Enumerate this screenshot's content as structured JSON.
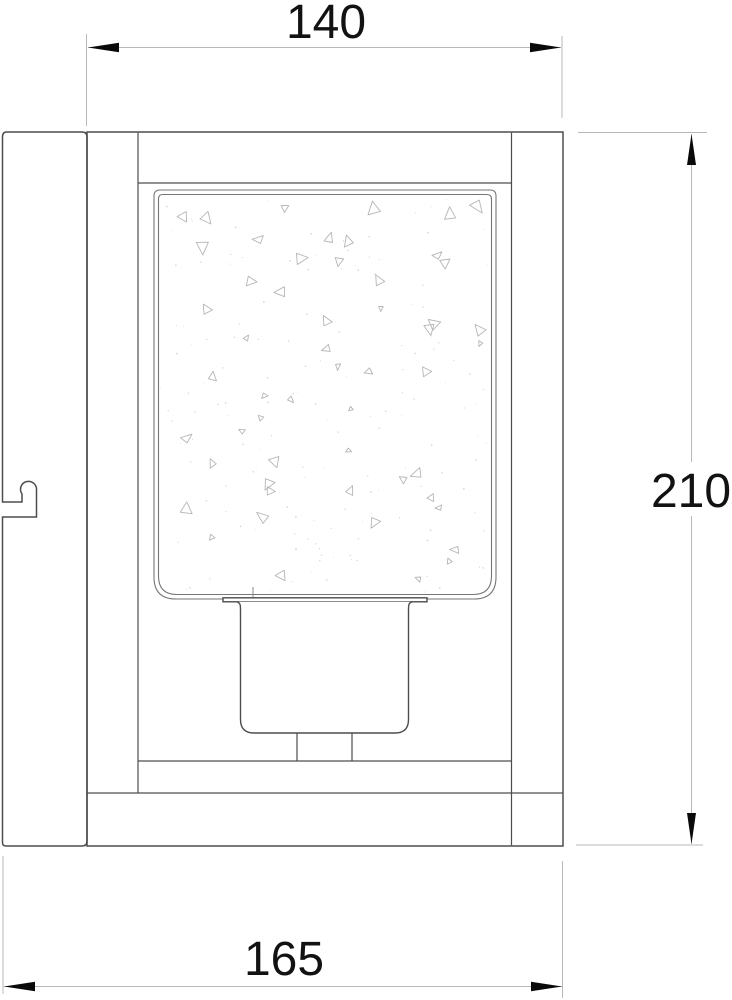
{
  "drawing": {
    "kind": "technical line drawing",
    "dimension_labels": {
      "top": "140",
      "right": "210",
      "bottom": "165"
    },
    "colors": {
      "background": "#ffffff",
      "outline": "#4d4d4d",
      "glass_outline": "#767676",
      "dimension_line": "#b8b8b8",
      "arrowhead": "#0a0a0a",
      "label_text": "#121212",
      "seed_triangle": "#b5b5b5",
      "seed_dot": "#d6d6d6"
    },
    "texture": {
      "name": "seeded-glass",
      "triangle_count": 54,
      "dot_count": 150
    }
  }
}
